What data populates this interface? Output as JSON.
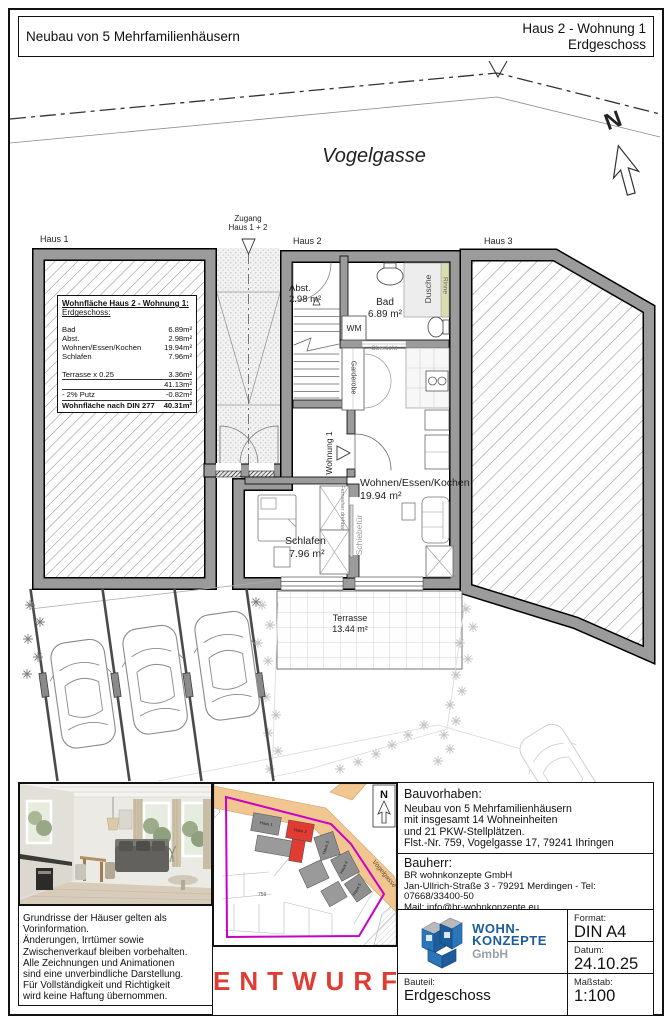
{
  "title_block": {
    "project": "Neubau von 5 Mehrfamilienhäusern",
    "sheet_title": "Haus 2 - Wohnung 1",
    "sheet_subtitle": "Erdgeschoss"
  },
  "plan": {
    "street_name": "Vogelgasse",
    "north_letter": "N",
    "houses": {
      "haus1": "Haus 1",
      "haus2": "Haus 2",
      "haus3": "Haus 3"
    },
    "entrance_note_line1": "Zugang",
    "entrance_note_line2": "Haus 1 + 2",
    "rooms": {
      "abst": {
        "name": "Abst.",
        "area": "2.98 m²"
      },
      "bad": {
        "name": "Bad",
        "area": "6.89 m²"
      },
      "wohnen": {
        "name": "Wohnen/Essen/Kochen",
        "area": "19.94 m²"
      },
      "schlafen": {
        "name": "Schlafen",
        "area": "7.96 m²"
      },
      "terrasse": {
        "name": "Terrasse",
        "area": "13.44 m²"
      }
    },
    "fixtures": {
      "wm": "WM",
      "dusche": "Dusche",
      "rinne": "Rinne",
      "oberlicht": "Oberlicht",
      "garderobe": "Garderobe",
      "wohnung1": "Wohnung 1",
      "schiebetuer": "Schiebetür",
      "fernseher": "Fernseher drehbar"
    }
  },
  "area_table": {
    "title": "Wohnfläche Haus 2 - Wohnung 1:",
    "subtitle": "Erdgeschoss:",
    "rows": [
      {
        "label": "Bad",
        "value": "6.89m²"
      },
      {
        "label": "Abst.",
        "value": "2.98m²"
      },
      {
        "label": "Wohnen/Essen/Kochen",
        "value": "19.94m²"
      },
      {
        "label": "Schlafen",
        "value": "7.96m²"
      }
    ],
    "terrace_row": {
      "label": "Terrasse x 0.25",
      "value": "3.36m²"
    },
    "subtotal": "41.13m²",
    "putz_row": {
      "label": "- 2% Putz",
      "value": "-0.82m²"
    },
    "total_row": {
      "label": "Wohnfläche nach DIN 277",
      "value": "40.31m²"
    }
  },
  "site_plan": {
    "street_label": "Vogelgasse",
    "parcel_number": "759",
    "north_letter": "N",
    "house_labels": [
      "Haus 1",
      "Haus 2",
      "Haus 3",
      "Haus 4",
      "Haus 5"
    ]
  },
  "stamp": {
    "watermark": "ENTWURF"
  },
  "disclaimer": {
    "lines": [
      "Grundrisse der Häuser gelten als Vorinformation.",
      "Änderungen, Irrtümer sowie",
      "Zwischenverkauf bleiben vorbehalten.",
      "Alle Zeichnungen und Animationen",
      "sind eine unverbindliche Darstellung.",
      "Für Vollständigkeit und Richtigkeit",
      "wird keine Haftung übernommen."
    ]
  },
  "project_info": {
    "bauvorhaben_label": "Bauvorhaben:",
    "bauvorhaben_lines": [
      "Neubau von 5 Mehrfamilienhäusern",
      "mit insgesamt 14 Wohneinheiten",
      "und 21 PKW-Stellplätzen.",
      "Flst.-Nr. 759, Vogelgasse 17, 79241 Ihringen"
    ],
    "bauherr_label": "Bauherr:",
    "bauherr_lines": [
      "BR wohnkonzepte GmbH",
      "Jan-Ullrich-Straße 3 - 79291 Merdingen - Tel: 07668/33400-50",
      "Mail: info@br-wohnkonzepte.eu",
      "Homepage: www.br-wohnkonzepte.eu"
    ]
  },
  "title_fields": {
    "format_label": "Format:",
    "format_value": "DIN A4",
    "datum_label": "Datum:",
    "datum_value": "24.10.25",
    "bauteil_label": "Bauteil:",
    "bauteil_value": "Erdgeschoss",
    "massstab_label": "Maßstab:",
    "massstab_value": "1:100"
  },
  "logo": {
    "line1": "WOHN-",
    "line2": "KONZEPTE",
    "line3": "GmbH"
  },
  "colors": {
    "wall_gray": "#9b9b9b",
    "accent_red": "#e03c34",
    "road_orange": "#f2c690",
    "boundary_magenta": "#c800c8",
    "logo_blue": "#1d5d99",
    "rinne_green": "#d9dcae"
  }
}
